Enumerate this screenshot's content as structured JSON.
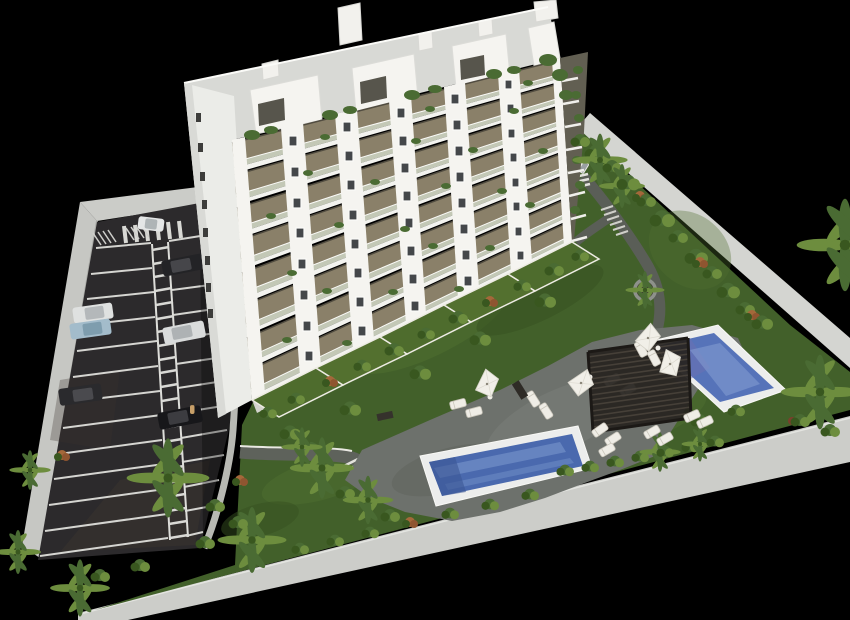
{
  "scene": {
    "type": "architectural-3d-rendering",
    "description": "Aerial 3D render of a white residential apartment building with landscaped grounds, a striped parking lot with cars, two blue swimming pools, a slatted pergola sun deck with white umbrellas and loungers, all enclosed by light perimeter walls on a black background",
    "background": "#000000"
  },
  "palette": {
    "bg": "#000000",
    "building-white": "#f5f4f0",
    "west-face": "#ebece8",
    "recess-shadow": "#8a8069",
    "railing-glass": "#c3c8b6",
    "slab-white": "#f3f3ef",
    "window-dark": "#44474a",
    "roof-terrace": "#d8d9d5",
    "wall-gray": "#c6c7c3",
    "asphalt": "#2c2a2c",
    "marking-white": "#d9d9d5",
    "sidewalk": "#b8b9b3",
    "grass": "#42602a",
    "grass-light": "#4f7030",
    "grass-dark": "#35501f",
    "paving": "#6d716c",
    "path": "#5e625b",
    "pool-deck": "#ecedec",
    "pool-water": "#4a69ae",
    "pool-water-light": "#7e9bd0",
    "pool-water-deep": "#3c5694",
    "pool-water-upper": "#5673b9",
    "pergola": "#26221e",
    "umbrella": "#f1efe8",
    "lounger": "#efede6",
    "foliage": "#4a6b33",
    "foliage-light": "#6d8d3e",
    "foliage-dark": "#39571f",
    "trunk": "#8a7a5e",
    "red-shrub": "#a4683a",
    "car-white": "#e4e6e6",
    "car-dark": "#232326",
    "car-blue": "#a3bccb",
    "car-silver": "#d9dbdb",
    "car-suv": "#2a2a2d",
    "car-black": "#17171a",
    "van-white": "#e9e9e5"
  },
  "building": {
    "floors_visible": 8,
    "balcony_bays_per_floor": 6,
    "wall_window_columns": 5,
    "penthouse_volumes": 4,
    "roof_vents": 5,
    "west_windows": 8
  },
  "parking": {
    "marked_bays_left": 13,
    "marked_bays_right": 13,
    "walkway_stripes": 22,
    "crosswalk_stripes": 6,
    "cars": [
      {
        "name": "white-car-driving",
        "color": "#e4e6e6"
      },
      {
        "name": "dark-car",
        "color": "#232326"
      },
      {
        "name": "white-car-parked",
        "color": "#dfe1e0"
      },
      {
        "name": "blue-car",
        "color": "#a3bccb"
      },
      {
        "name": "silver-car",
        "color": "#d9dbdb"
      },
      {
        "name": "dark-suv",
        "color": "#2a2a2d"
      },
      {
        "name": "black-car",
        "color": "#17171a"
      },
      {
        "name": "white-van",
        "color": "#e9e9e5"
      }
    ],
    "pedestrians": 1
  },
  "pools": [
    {
      "name": "lower-pool",
      "water": "#4a69ae"
    },
    {
      "name": "upper-pool",
      "water": "#5673b9"
    }
  ],
  "amenities": {
    "pergolas": 1,
    "umbrellas": 4,
    "sun_loungers": 15,
    "round_planters": 1,
    "garden_terraces": 5
  },
  "vegetation": {
    "palm_trees": 14,
    "shrubs": 52,
    "flowering_shrubs": 9
  }
}
